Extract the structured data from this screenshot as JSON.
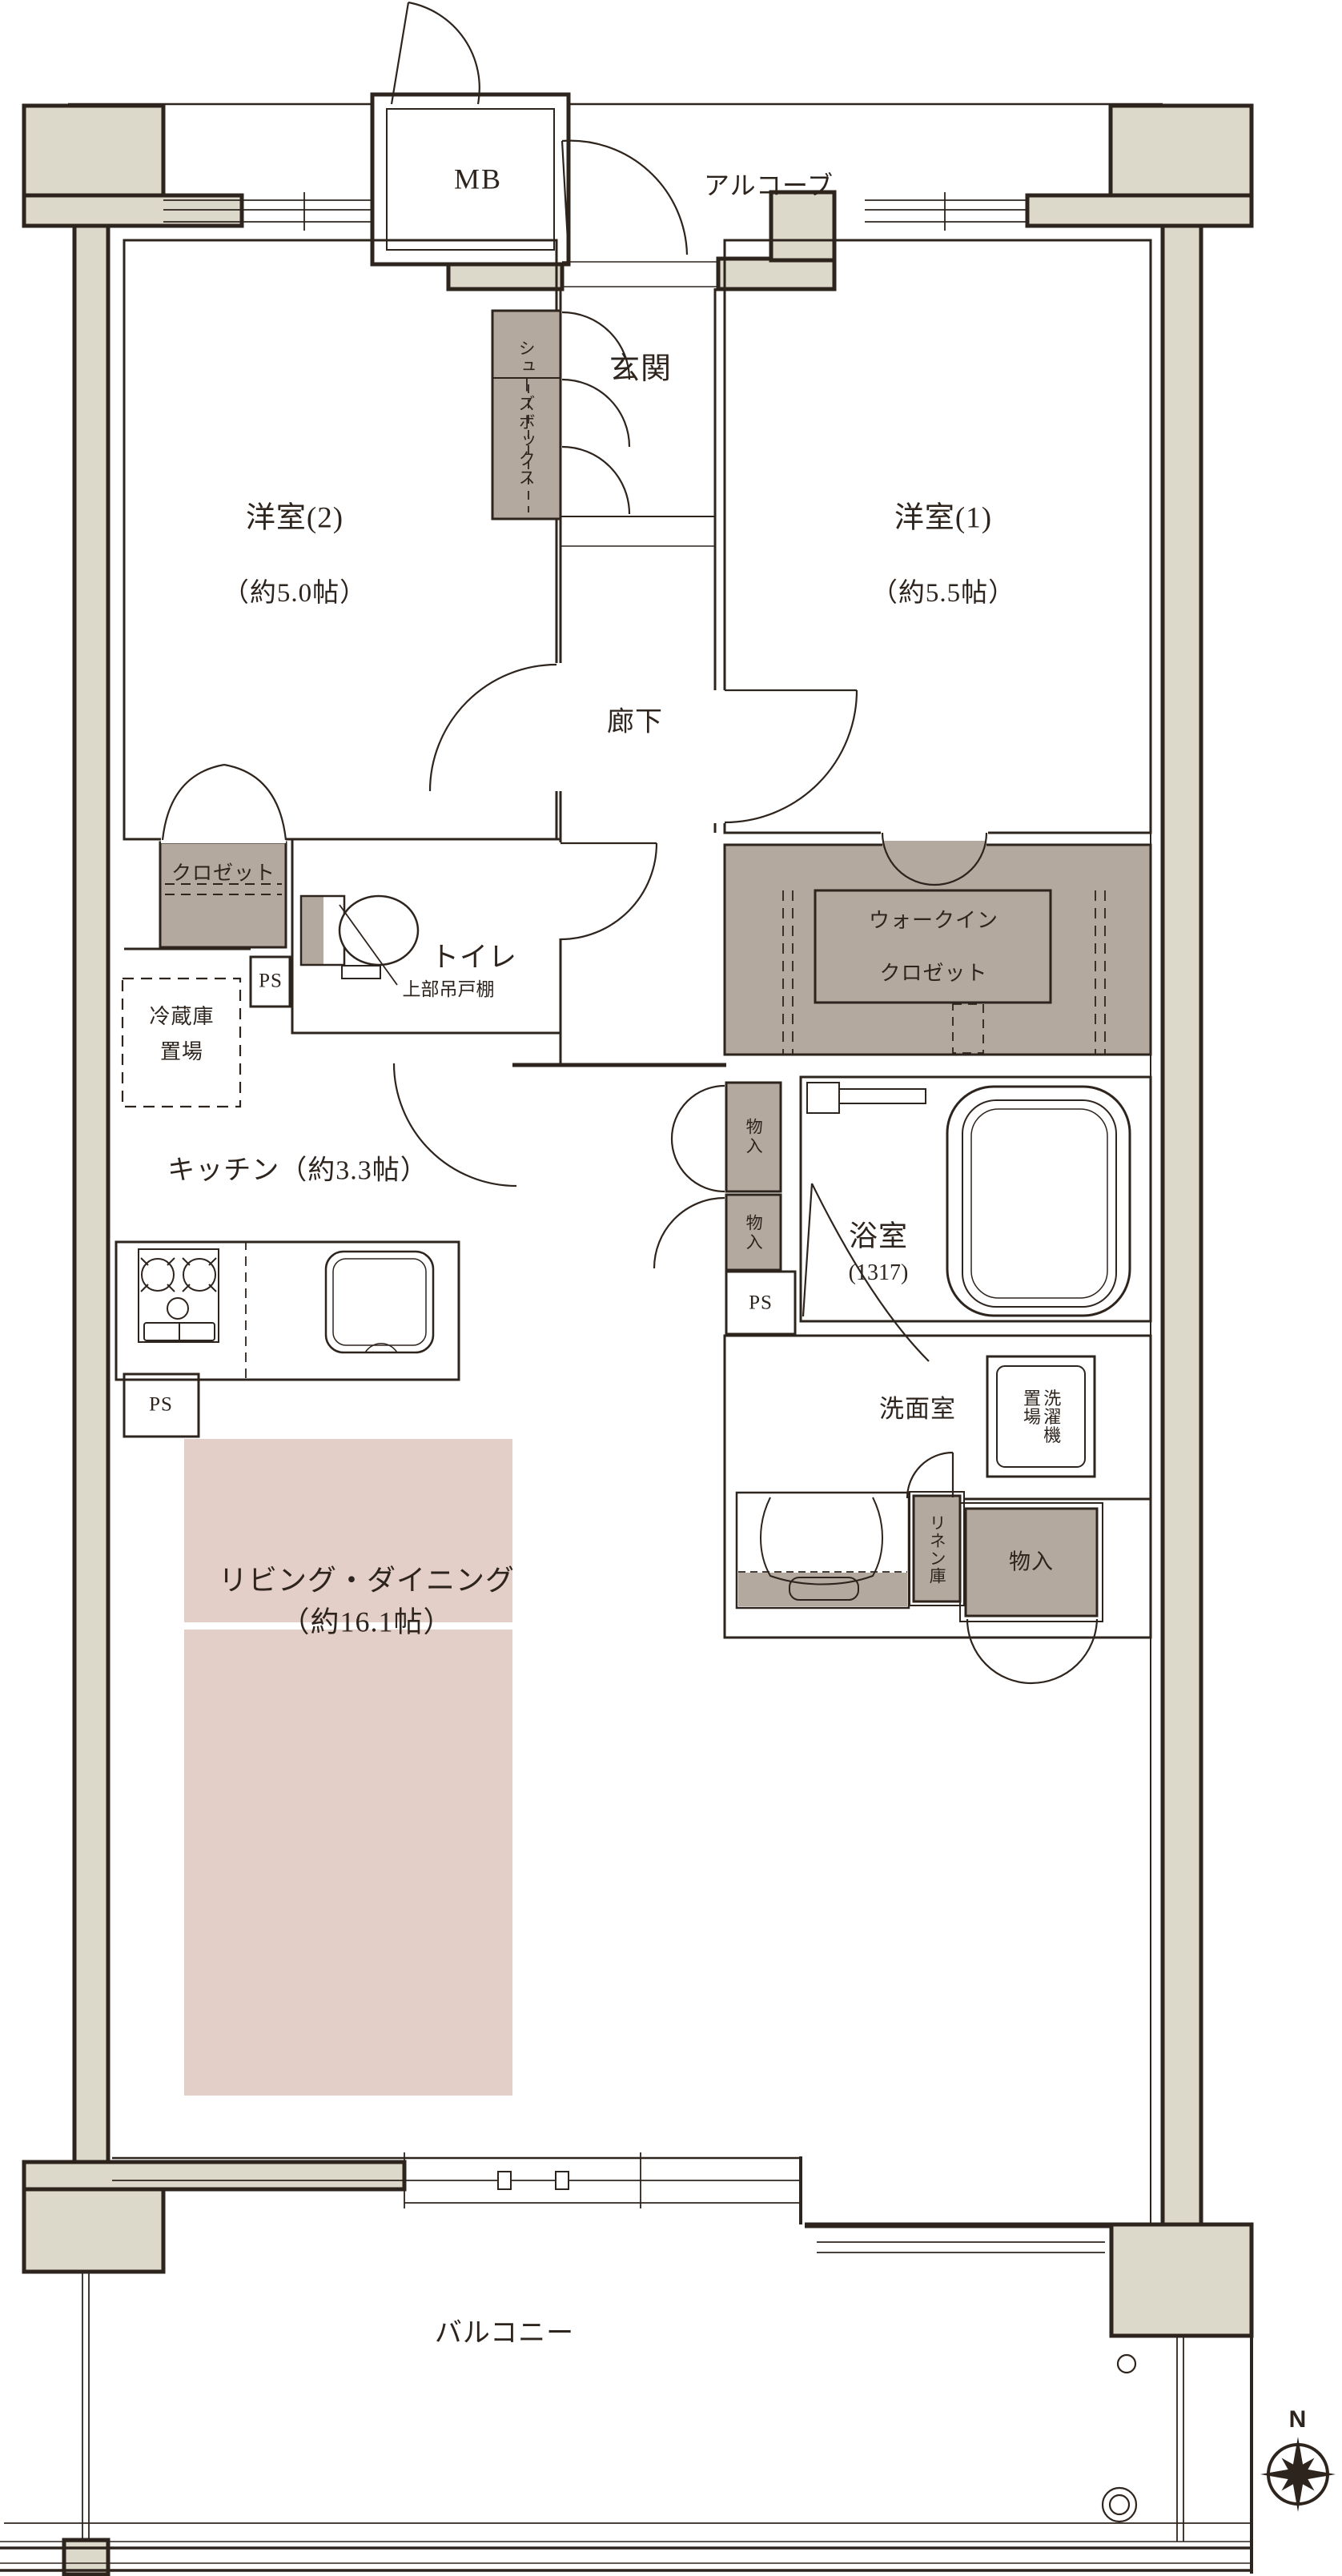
{
  "plan": {
    "labels": {
      "alcove": "アルコーブ",
      "meter_box": "MB",
      "entrance": "玄関",
      "shoe_box": "シューズボックス",
      "western_room_2": {
        "name": "洋室(2)",
        "size": "（約5.0帖）"
      },
      "western_room_1": {
        "name": "洋室(1)",
        "size": "（約5.5帖）"
      },
      "hallway": "廊下",
      "closet": "クロゼット",
      "pipe_space": "PS",
      "toilet": "トイレ",
      "upper_cabinet": "上部吊戸棚",
      "walk_in_closet_line1": "ウォークイン",
      "walk_in_closet_line2": "クロゼット",
      "fridge_space_line1": "冷蔵庫",
      "fridge_space_line2": "置場",
      "kitchen": "キッチン（約3.3帖）",
      "storage": "物入",
      "bathroom": {
        "name": "浴室",
        "size": "(1317)"
      },
      "washroom": "洗面室",
      "washer_space": "洗濯機\n置場",
      "linen_storage": "リネン庫",
      "living_dining": {
        "name": "リビング・ダイニング",
        "size": "（約16.1帖）"
      },
      "balcony": "バルコニー",
      "compass_north": "N"
    },
    "colors": {
      "wall_fill": "#dcd8ca",
      "storage_fill": "#b3a99e",
      "floor_accent": "#e3cfc8",
      "line": "#2e241e"
    }
  }
}
